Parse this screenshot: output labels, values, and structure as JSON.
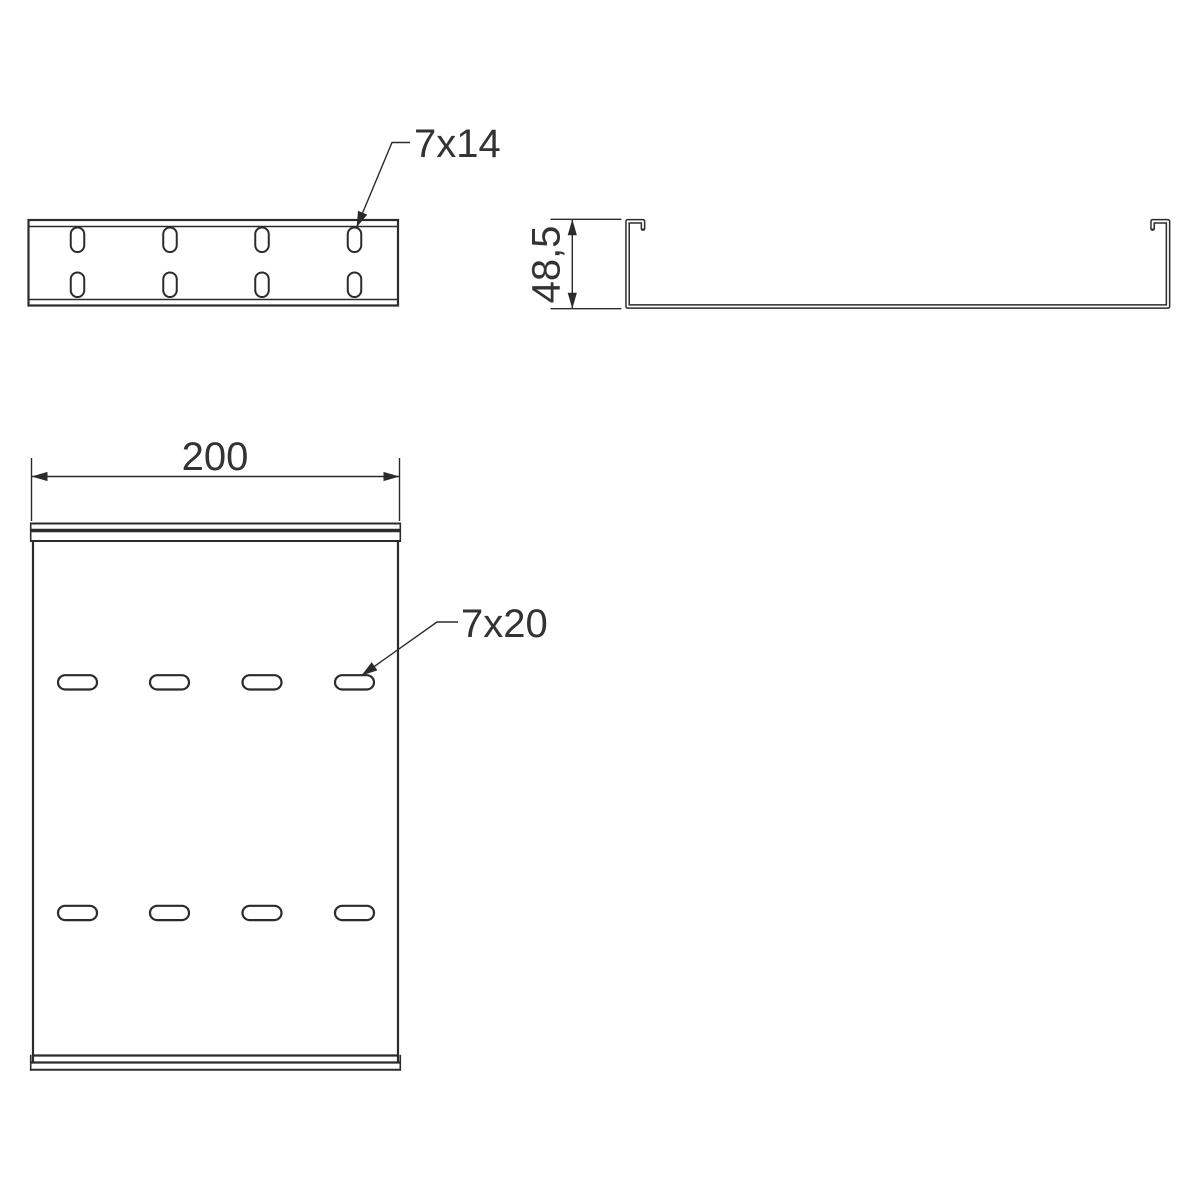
{
  "drawing": {
    "background_color": "#ffffff",
    "line_color": "#2b2b2b",
    "text_color": "#333333",
    "labels": {
      "front_slot": "7x14",
      "plan_slot": "7x20",
      "plan_width": "200",
      "section_height": "48,5"
    },
    "views": [
      {
        "id": "front-view",
        "description": "front elevation with oblong slots",
        "slot_size_label": "7x14",
        "slot_rows": 2,
        "slot_columns": 4
      },
      {
        "id": "profile-section",
        "description": "U-channel profile with inturned lips",
        "height_label": "48,5"
      },
      {
        "id": "plan-view",
        "description": "base plan with oblong slots",
        "width_label": "200",
        "slot_size_label": "7x20",
        "slot_rows": 2,
        "slot_columns": 4
      }
    ]
  }
}
